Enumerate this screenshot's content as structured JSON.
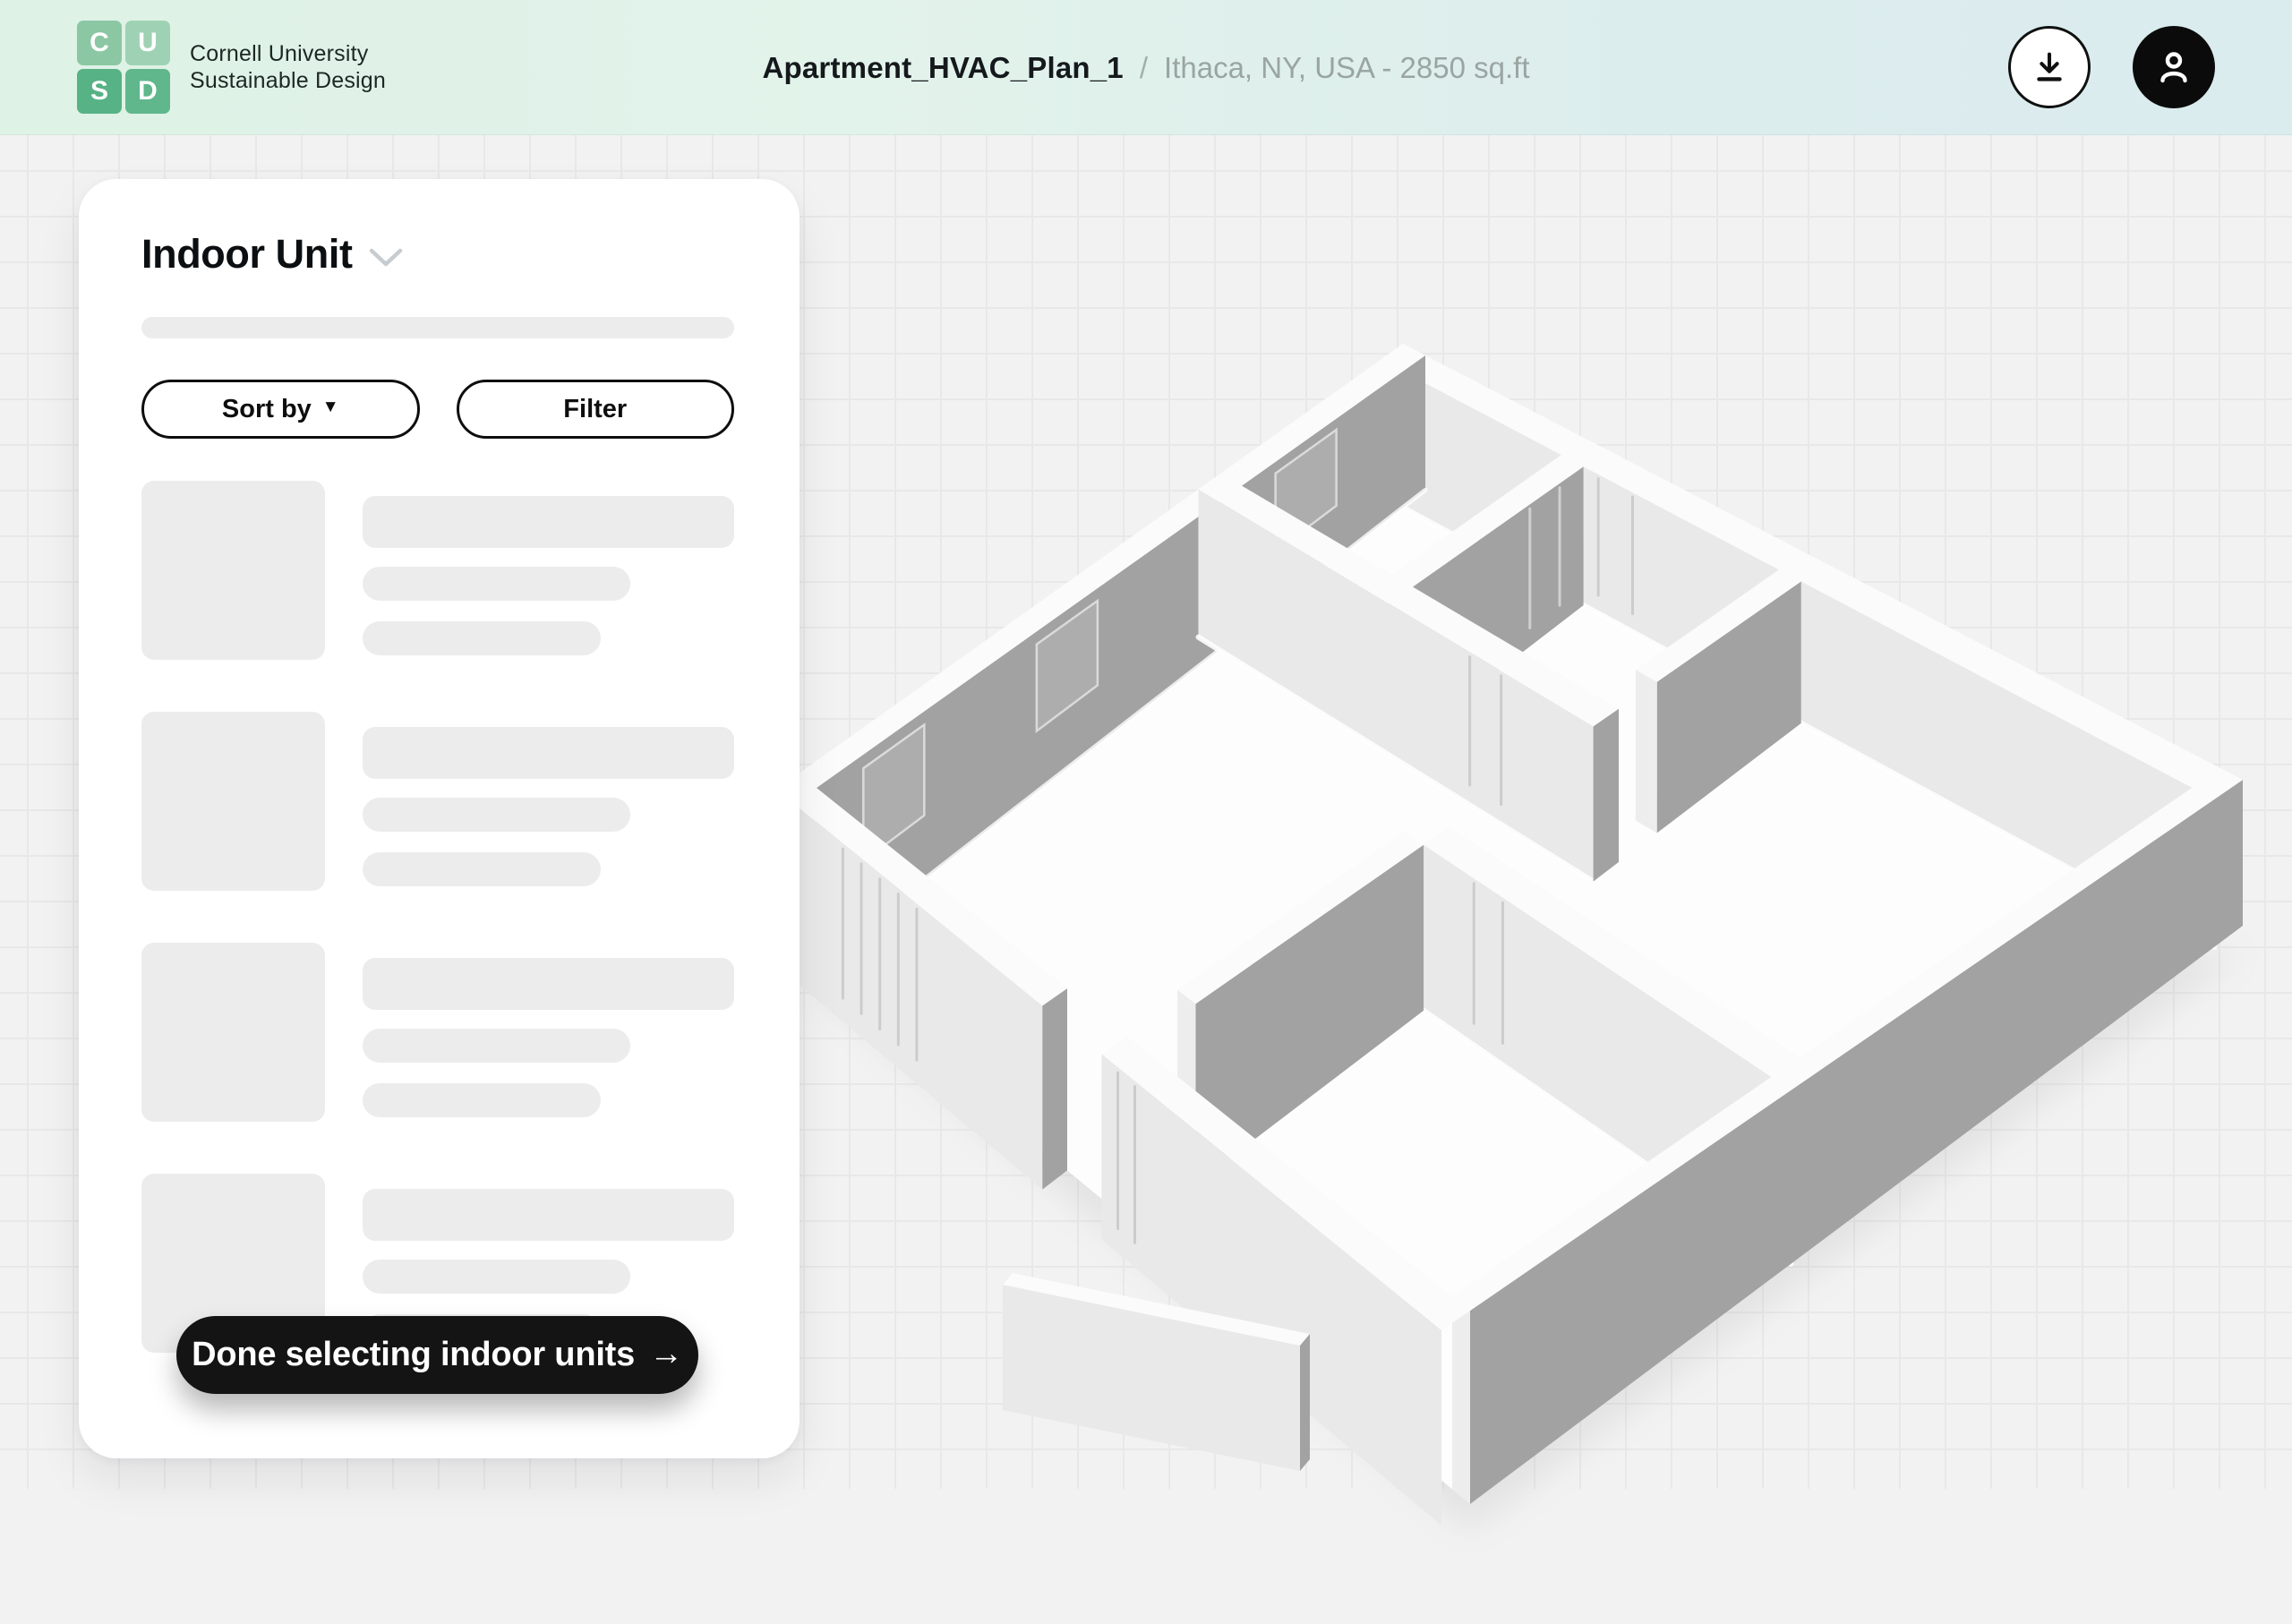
{
  "header": {
    "logo": {
      "tiles": [
        {
          "letter": "C",
          "color": "#8bc7a3",
          "dotted": false
        },
        {
          "letter": "U",
          "color": "#9fd2b4",
          "dotted": true
        },
        {
          "letter": "S",
          "color": "#57b285",
          "dotted": false
        },
        {
          "letter": "D",
          "color": "#5fb78b",
          "dotted": false
        }
      ],
      "line1": "Cornell University",
      "line2": "Sustainable Design"
    },
    "title": "Apartment_HVAC_Plan_1",
    "separator": "/",
    "subtitle": "Ithaca, NY, USA - 2850 sq.ft",
    "icons": {
      "download": "download-icon",
      "profile": "user-icon"
    }
  },
  "panel": {
    "title": "Indoor Unit",
    "title_chevron_icon": "chevron-down-icon",
    "sort_label": "Sort by",
    "sort_caret": "▼",
    "filter_label": "Filter",
    "skeleton_count": 4,
    "done_label": "Done selecting indoor units",
    "done_arrow": "→"
  },
  "colors": {
    "header_gradient_left": "#def2e5",
    "header_gradient_right": "#dbecef",
    "canvas_bg": "#f2f2f2",
    "grid_line": "#e8e8e8",
    "skeleton": "#ececec",
    "button_dark": "#141414",
    "accent_green": "#57b285"
  },
  "floorplan": {
    "corners": {
      "L": [
        892,
        713
      ],
      "T": [
        1567,
        233
      ],
      "R": [
        2505,
        720
      ],
      "B": [
        1642,
        1313
      ]
    },
    "heights": {
      "L": 195,
      "T": 150,
      "R": 163,
      "B": 216
    },
    "extent": {
      "u": 9,
      "v": 6.5
    },
    "thickness": 0.24,
    "colors": {
      "gray": "#a2a2a2",
      "grayLight": "#adadad",
      "light": "#e9e9e9",
      "cap": "#ededed",
      "top": "#fbfbfb",
      "floor": "#fdfdfd",
      "jambLight": "#c8c8c8",
      "jambOnGray": "#d6d6d6",
      "windowStroke": "#dadada",
      "shadow": "#8a8a8a",
      "baseGlow": "#ffffff"
    },
    "floor_poly": [
      [
        0,
        0
      ],
      [
        9,
        0
      ],
      [
        9,
        6.5
      ],
      [
        0,
        6.5
      ]
    ],
    "walls": [
      {
        "id": "north-outer-wall",
        "axis": "u",
        "at": 6.26,
        "from": 0,
        "to": 9,
        "jambs": [
          2.35,
          2.72
        ],
        "baseGlow": true
      },
      {
        "id": "west-outer-wall",
        "axis": "v",
        "at": 0,
        "from": 0,
        "to": 6.5,
        "windows": [
          [
            0.5,
            1.15
          ],
          [
            2.35,
            3.0
          ],
          [
            4.9,
            5.55
          ]
        ],
        "baseGlow": true
      },
      {
        "id": "bedroom-divider-wall",
        "axis": "v",
        "at": 1.95,
        "from": 4.3,
        "to": 6.26,
        "jambs": [
          5.72,
          6.02
        ]
      },
      {
        "id": "closet-stub-wall",
        "axis": "v",
        "at": 4.3,
        "from": 4.9,
        "to": 6.26,
        "capStart": true
      },
      {
        "id": "central-wall",
        "axis": "u",
        "at": 4.3,
        "from": 0,
        "to": 4.54,
        "capEnd": true,
        "jambs": [
          3.12,
          3.48
        ],
        "baseGlow": true
      },
      {
        "id": "east-mid-wall",
        "axis": "u",
        "at": 2.7,
        "from": 4.54,
        "to": 9,
        "jambs": [
          5.15,
          5.5
        ],
        "baseGlow": true
      },
      {
        "id": "bath-wall",
        "axis": "v",
        "at": 4.3,
        "from": 0.55,
        "to": 2.7,
        "capStart": true
      },
      {
        "id": "east-outer-wall",
        "axis": "v",
        "at": 8.76,
        "from": 0,
        "to": 6.5,
        "capStart": true
      },
      {
        "id": "south-outer-wall-left",
        "axis": "u",
        "at": -0.24,
        "from": 0,
        "to": 3.6,
        "capEnd": true,
        "jambs": [
          0.9,
          1.15,
          1.4,
          1.65,
          1.9
        ]
      },
      {
        "id": "south-outer-wall-right",
        "axis": "u",
        "at": -0.24,
        "from": 4.4,
        "to": 9,
        "jambs": [
          4.62,
          4.85
        ]
      }
    ],
    "extra": [
      {
        "name": "entry-wall-front",
        "points": [
          [
            1120,
            1284
          ],
          [
            1452,
            1352
          ],
          [
            1452,
            1492
          ],
          [
            1120,
            1424
          ]
        ],
        "fill": "light"
      },
      {
        "name": "entry-wall-top",
        "points": [
          [
            1120,
            1284
          ],
          [
            1131,
            1271
          ],
          [
            1463,
            1339
          ],
          [
            1452,
            1352
          ]
        ],
        "fill": "top"
      },
      {
        "name": "entry-wall-cap",
        "points": [
          [
            1452,
            1352
          ],
          [
            1463,
            1339
          ],
          [
            1463,
            1479
          ],
          [
            1452,
            1492
          ]
        ],
        "fill": "gray"
      }
    ]
  }
}
